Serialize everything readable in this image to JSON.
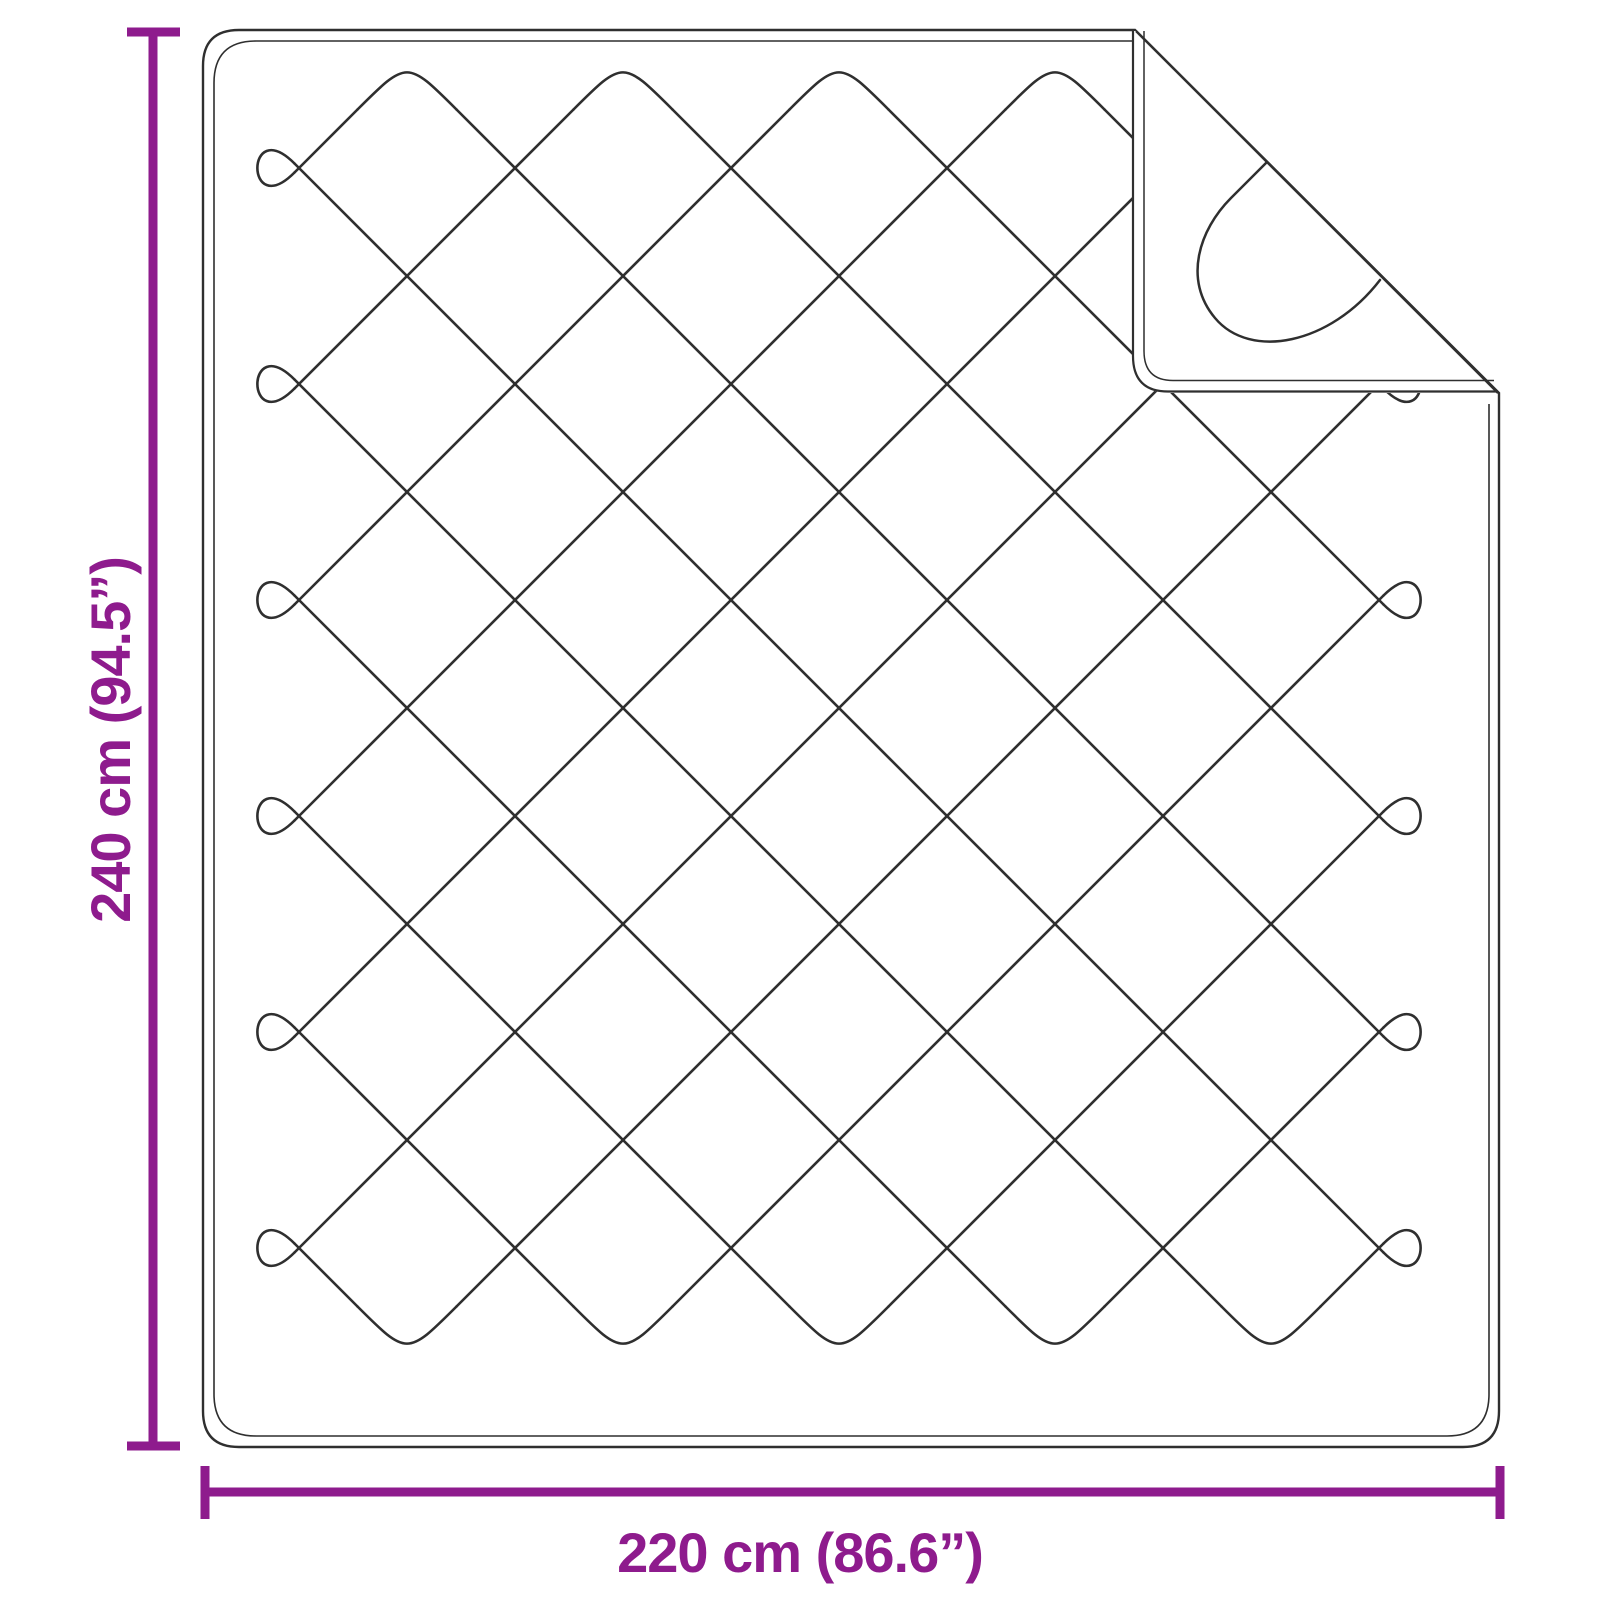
{
  "illustration": "quilted-blanket-with-folded-corner",
  "dimensions": {
    "height": {
      "label": "240 cm (94.5”)"
    },
    "width": {
      "label": "220 cm (86.6”)"
    }
  },
  "colors": {
    "accent": "#8E1B8D",
    "line_art": "#2f2f2f",
    "background": "#ffffff"
  }
}
